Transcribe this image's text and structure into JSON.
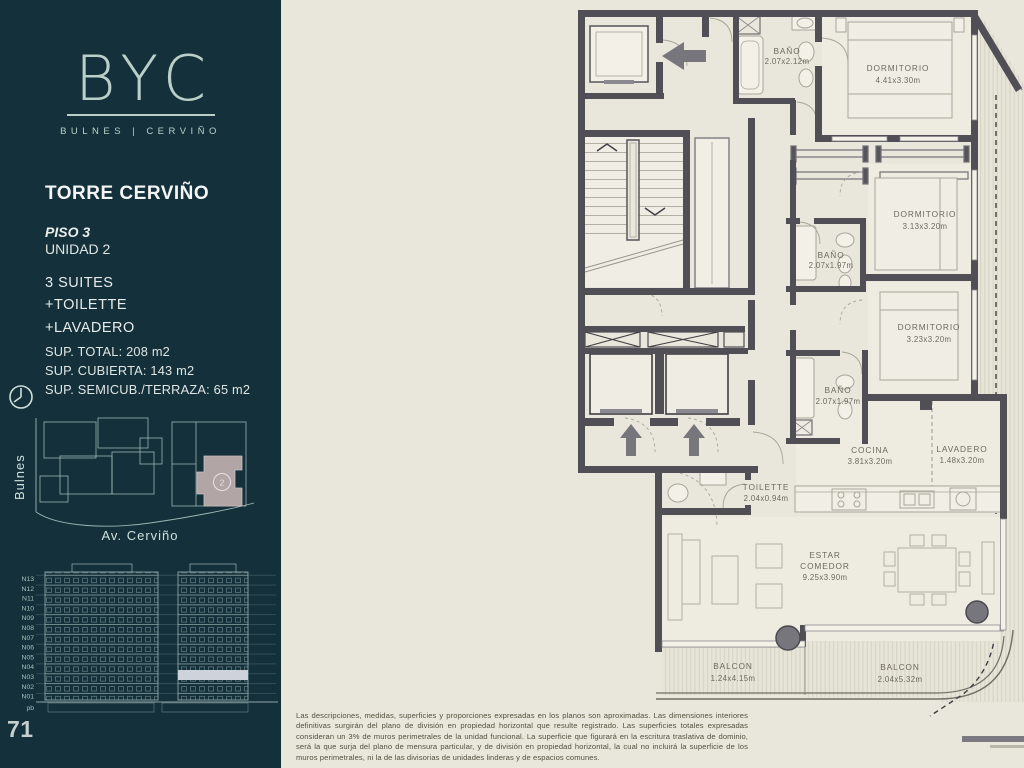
{
  "sidebar": {
    "logo": {
      "text": "BYC",
      "subtitle": "BULNES | CERVIÑO"
    },
    "project": {
      "title": "TORRE CERVIÑO",
      "floor": "PISO 3",
      "unit": "UNIDAD 2"
    },
    "features": [
      "3 SUITES",
      "+TOILETTE",
      "+LAVADERO"
    ],
    "areas": [
      "SUP. TOTAL: 208 m2",
      "SUP. CUBIERTA: 143 m2",
      "SUP. SEMICUB./TERRAZA: 65 m2"
    ],
    "map": {
      "street_left": "Bulnes",
      "street_bottom": "Av. Cerviño",
      "unit_badge": "2"
    },
    "elevation": {
      "floors": [
        "N13",
        "N12",
        "N11",
        "N10",
        "N09",
        "N08",
        "N07",
        "N06",
        "N05",
        "N04",
        "N03",
        "N02",
        "N01",
        "pb"
      ],
      "highlighted_floor": "N03"
    },
    "page_number": "71"
  },
  "plan": {
    "rooms": [
      {
        "name": "BAÑO",
        "dims": "2.07x2.12m"
      },
      {
        "name": "DORMITORIO",
        "dims": "4.41x3.30m"
      },
      {
        "name": "DORMITORIO",
        "dims": "3.13x3.20m"
      },
      {
        "name": "BAÑO",
        "dims": "2.07x1.97m"
      },
      {
        "name": "DORMITORIO",
        "dims": "3.23x3.20m"
      },
      {
        "name": "BAÑO",
        "dims": "2.07x1.97m"
      },
      {
        "name": "COCINA",
        "dims": "3.81x3.20m"
      },
      {
        "name": "LAVADERO",
        "dims": "1.48x3.20m"
      },
      {
        "name": "TOILETTE",
        "dims": "2.04x0.94m"
      },
      {
        "name": "ESTAR",
        "name2": "COMEDOR",
        "dims": "9.25x3.90m"
      },
      {
        "name": "BALCON",
        "dims": "1.24x4.15m"
      },
      {
        "name": "BALCON",
        "dims": "2.04x5.32m"
      }
    ]
  },
  "footer": {
    "disclaimer": "Las descripciones, medidas, superficies y proporciones expresadas en los planos son aproximadas. Las dimensiones interiores definitivas surgirán del plano de división en propiedad horizontal que resulte registrado. Las superficies totales expresadas consideran un 3% de muros perimetrales de la unidad funcional. La superficie que figurará en la escritura traslativa de dominio, será la que surja del plano de mensura particular, y de división en propiedad horizontal, la cual no incluirá la superficie de los muros perimetrales, ni la de las divisorias de unidades linderas y de espacios comunes."
  },
  "colors": {
    "sidebar_bg": "#14303b",
    "logo": "#b9cfc8",
    "plan_bg": "#e9e6db",
    "wall": "#4f4f55",
    "unit_highlight": "#b1a5a5",
    "floor_highlight": "#cdd2db",
    "arrow": "#76767c"
  }
}
